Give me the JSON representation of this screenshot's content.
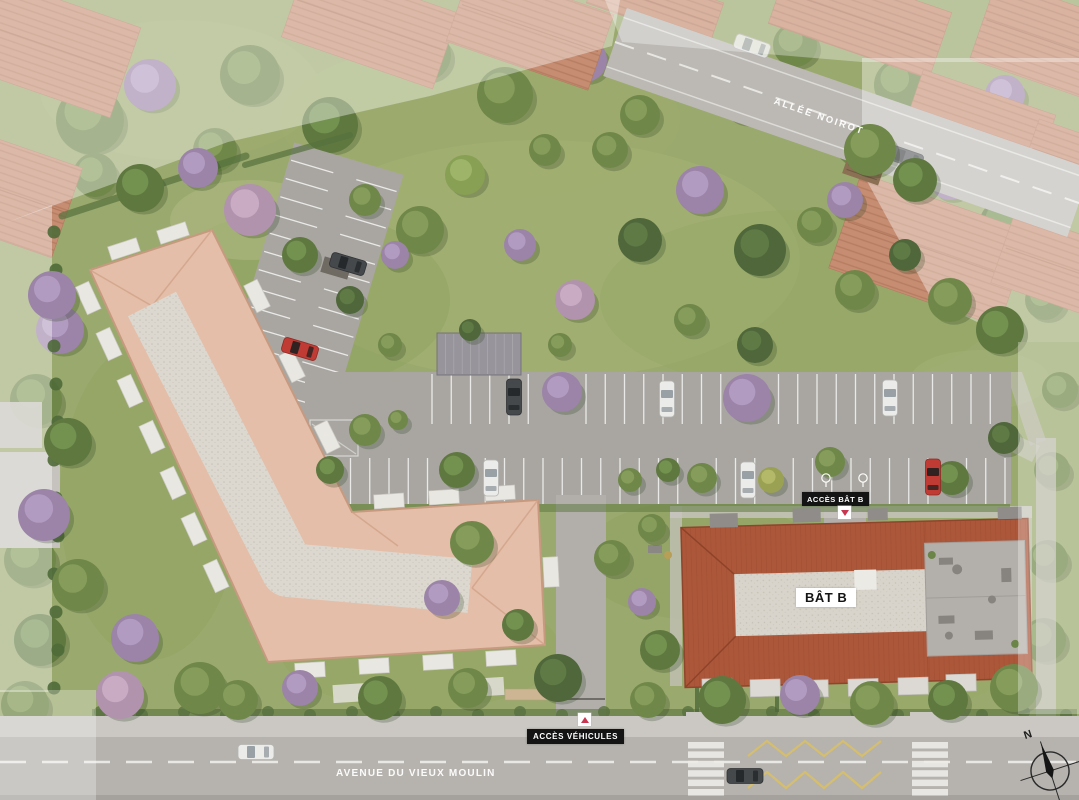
{
  "plan": {
    "streets": {
      "top": "ALLÉE NOIROT",
      "bottom": "AVENUE DU VIEUX MOULIN"
    },
    "building_b": {
      "label": "BÂT B"
    },
    "access": {
      "building_b": "ACCÈS BÂT B",
      "vehicles": "ACCÈS VÉHICULES"
    },
    "compass": {
      "north": "N"
    },
    "colors": {
      "grass": "#9aa96d",
      "asphalt": "#a9a6a1",
      "road": "#b6b3ae",
      "path": "#cbc8c3",
      "roof_building_a": "#e4bea8",
      "roof_building_b": "#ad573a",
      "gravel": "#d8d4cb",
      "hedge": "#5a7440",
      "label_bg": "#141414",
      "label_text": "#ffffff",
      "access_marker": "#c8374f",
      "marking_white": "#f2f1ee",
      "zigzag_yellow": "#d8bf66"
    },
    "icons": [
      "compass-icon",
      "access-marker-icon",
      "moto-parking-icon",
      "picnic-table-icon"
    ]
  }
}
